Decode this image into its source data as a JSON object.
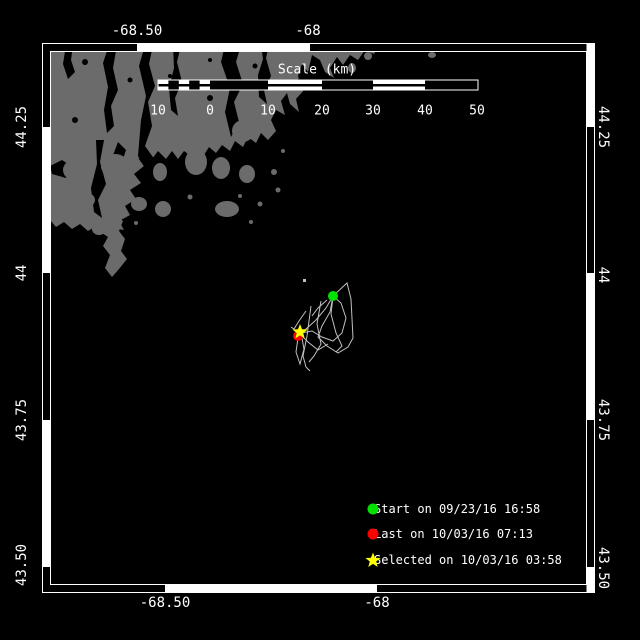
{
  "window": {
    "background": "#000000"
  },
  "map": {
    "frame_color": "#ffffff",
    "land_color": "#6b6b6b",
    "water_color": "#000000",
    "track_color": "#c0c0c0"
  },
  "axes": {
    "top_labels": [
      "-68.50",
      "-68"
    ],
    "bottom_labels": [
      "-68.50",
      "-68"
    ],
    "left_labels": [
      "44.25",
      "44",
      "43.75",
      "43.50"
    ],
    "right_labels": [
      "44.25",
      "44",
      "43.75",
      "43.50"
    ]
  },
  "scale_bar": {
    "title": "Scale (km)",
    "tick_labels": [
      "10",
      "0",
      "10",
      "20",
      "30",
      "40",
      "50"
    ]
  },
  "legend": {
    "items": [
      {
        "marker": "start-dot",
        "color": "#00e100",
        "label": "Start on 09/23/16 16:58"
      },
      {
        "marker": "last-dot",
        "color": "#ff0000",
        "label": "Last on 10/03/16 07:13"
      },
      {
        "marker": "selected-star",
        "color": "#ffff00",
        "label": "Selected on 10/03/16 03:58"
      }
    ]
  }
}
